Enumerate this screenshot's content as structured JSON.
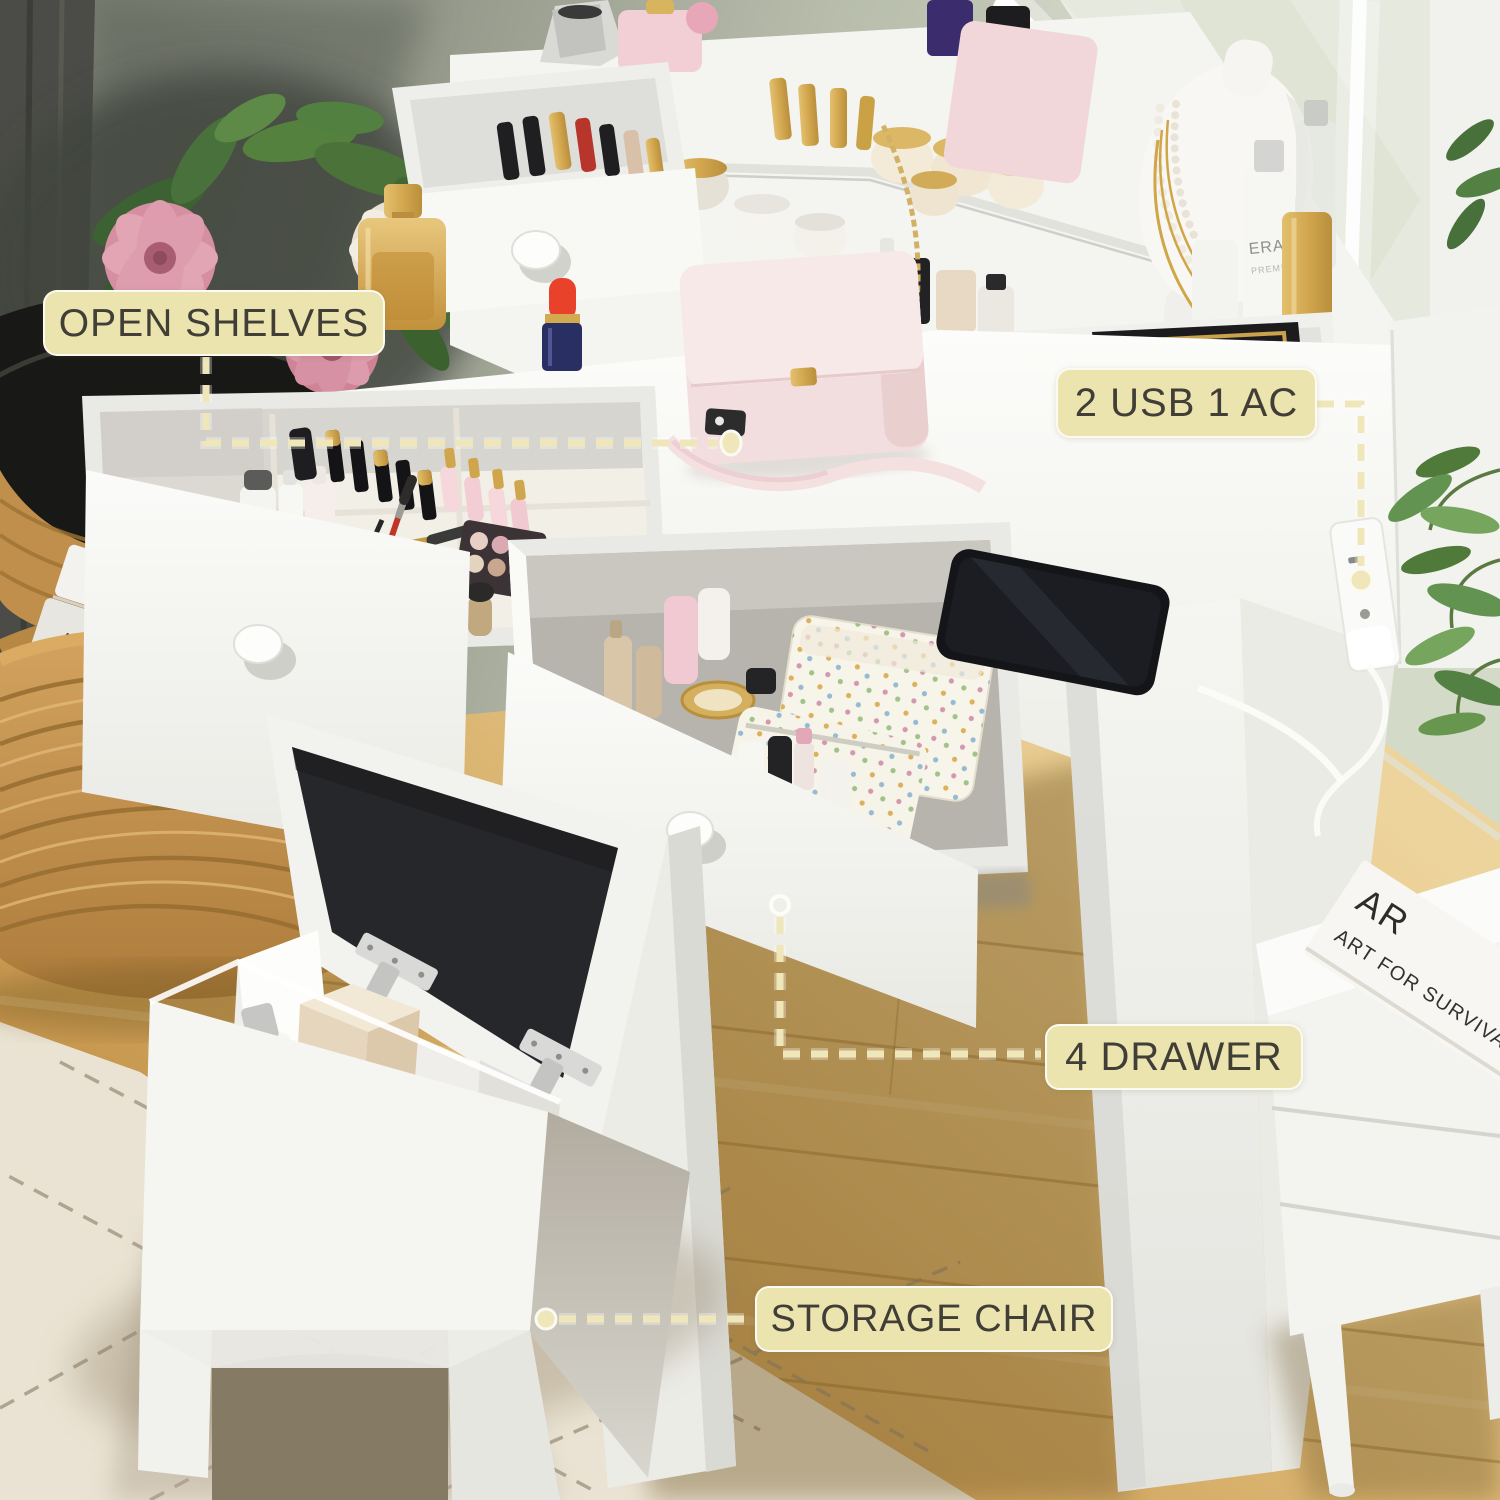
{
  "annotations": {
    "open_shelves": {
      "label": "OPEN SHELVES"
    },
    "power": {
      "label": "2 USB 1 AC"
    },
    "drawers": {
      "label": "4 DRAWER"
    },
    "chair": {
      "label": "STORAGE CHAIR"
    }
  },
  "scene_text": {
    "basket_book_spine": "ART FOR SURVIVAL",
    "nightstand_book_title_partial": "AR",
    "nightstand_book_spine": "ART FOR SURVIVAL",
    "serum_brand": "ERAC",
    "serum_line": "PREMIUM"
  },
  "colors": {
    "label_background": "#ebe4ae",
    "label_border": "#ffffff",
    "label_text": "#403e37",
    "connector_dash": "#efe7ba",
    "vanity_white": "#f5f5f2",
    "cushion_black": "#26272a",
    "floor_wood": "#cf9e55",
    "wall_sage": "#b8bdac",
    "rug_cream": "#eae3d3",
    "wicker_tan": "#c08f4c",
    "handbag_pink": "#f3dedf"
  }
}
